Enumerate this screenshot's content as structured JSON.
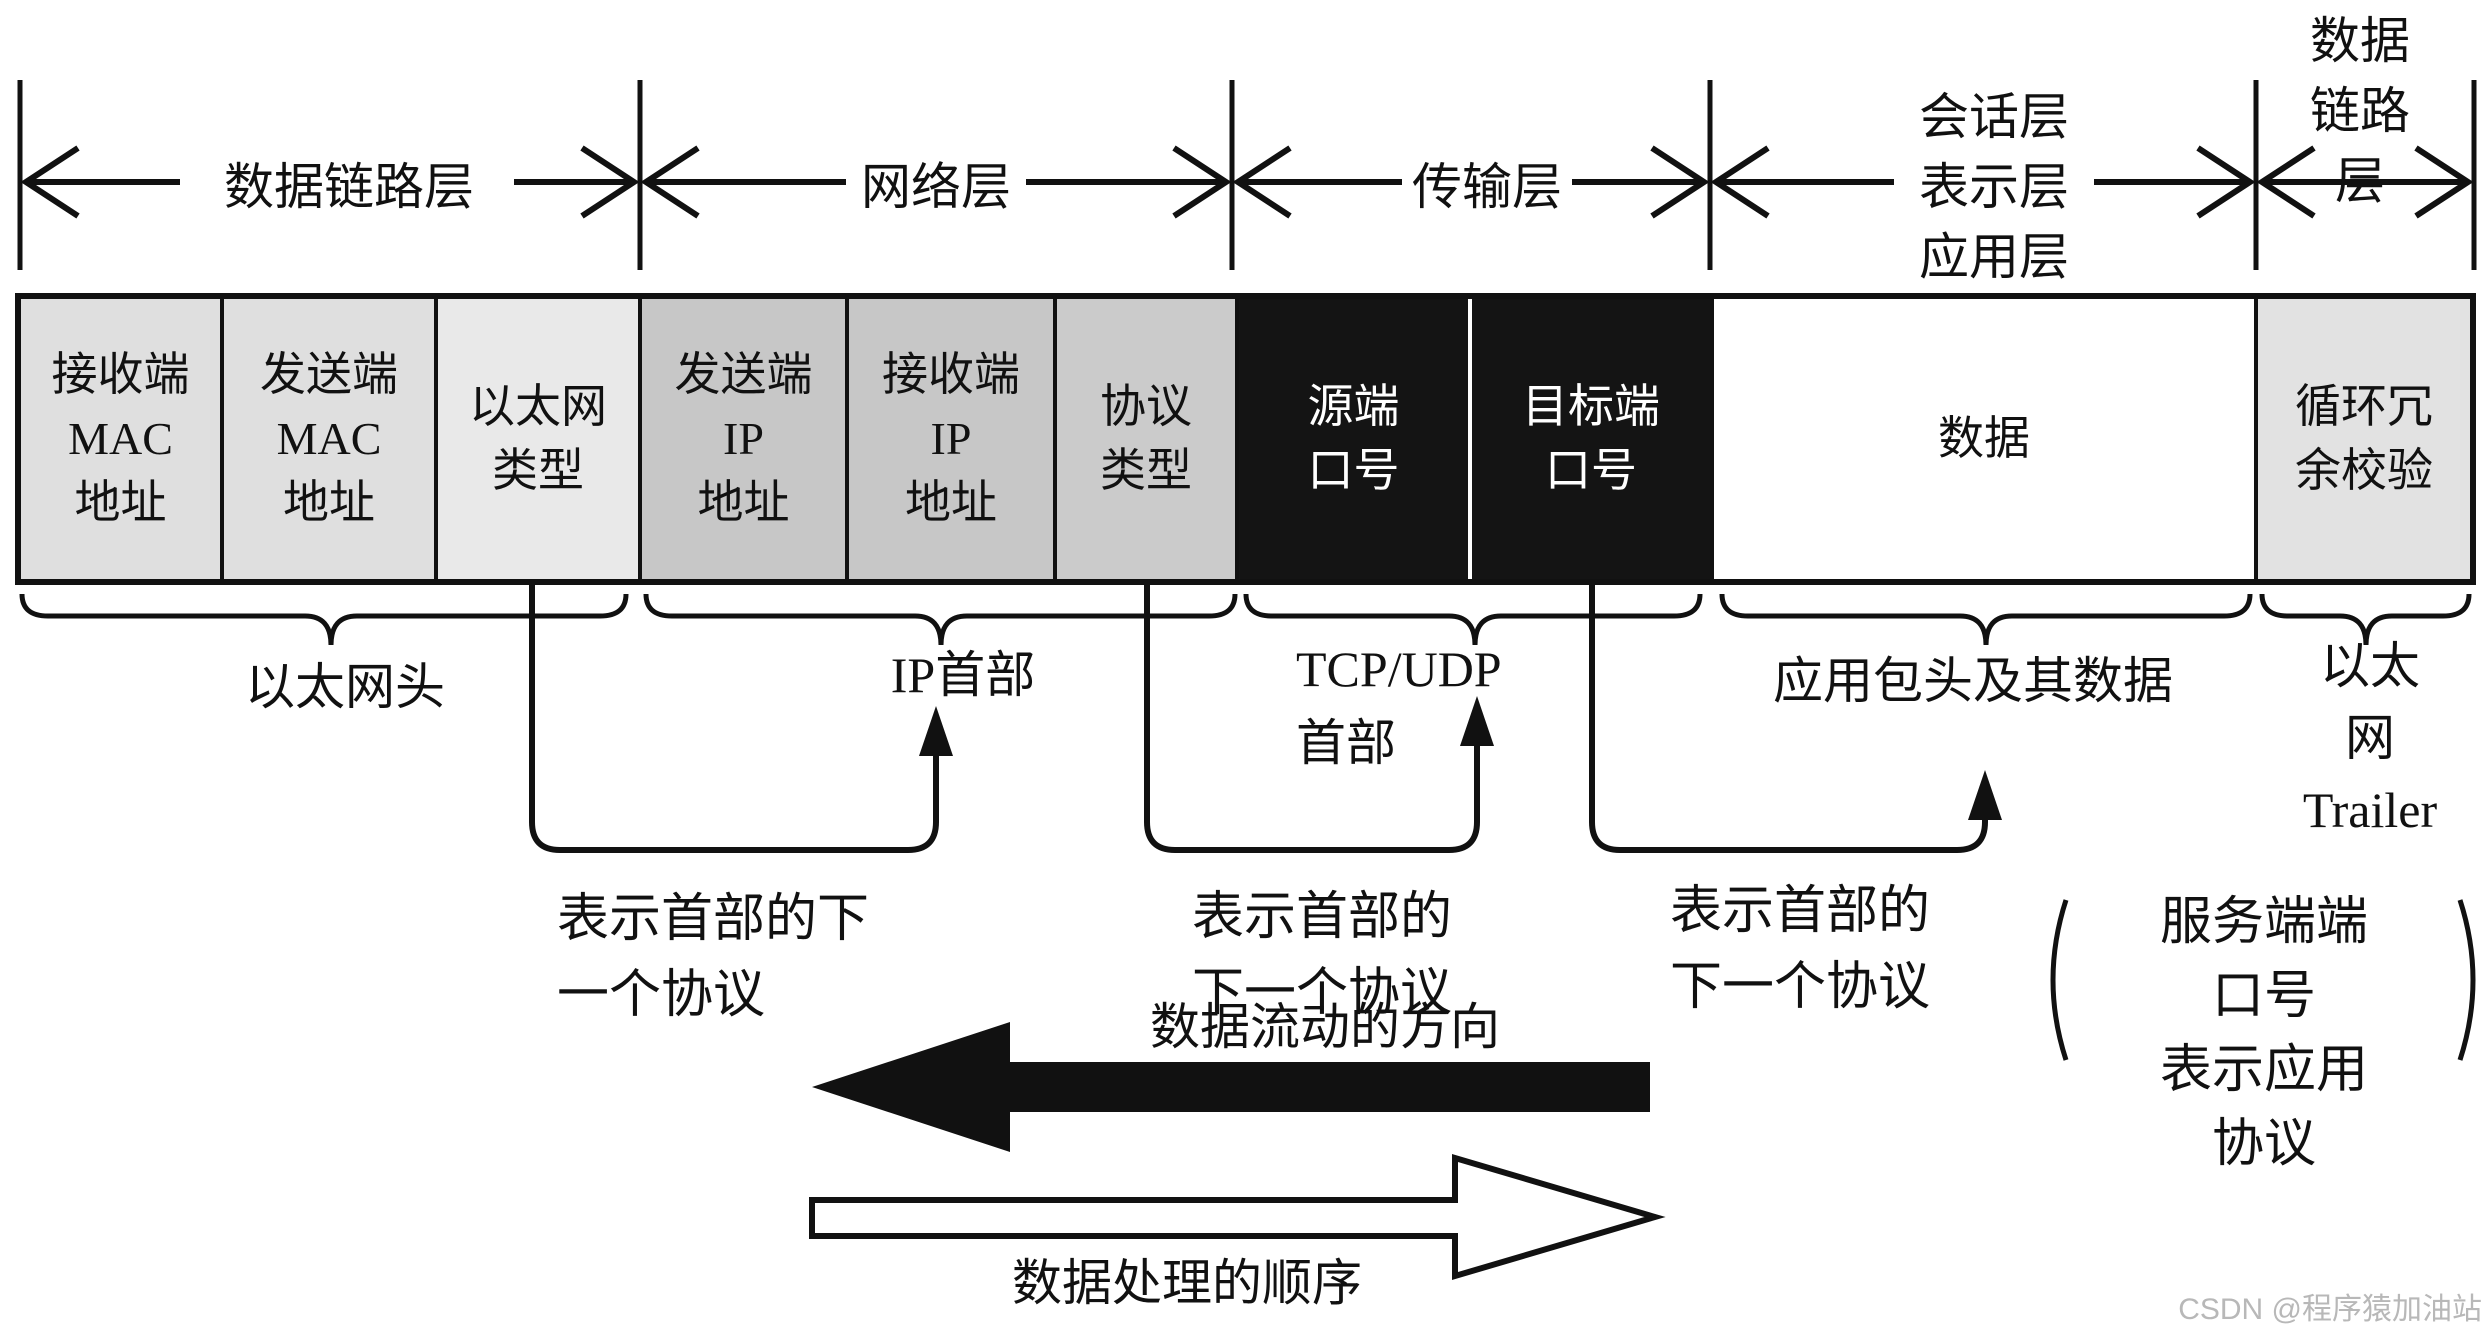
{
  "osi": {
    "datalink_left": "数据链路层",
    "network": "网络层",
    "transport": "传输层",
    "upper": [
      "会话层",
      "表示层",
      "应用层"
    ],
    "datalink_right": [
      "数据",
      "链路层"
    ]
  },
  "packet": {
    "cells": [
      {
        "label": "接收端\nMAC\n地址",
        "bg": "#dfdfdf",
        "fg": "#111111"
      },
      {
        "label": "发送端\nMAC\n地址",
        "bg": "#dfdfdf",
        "fg": "#111111"
      },
      {
        "label": "以太网\n类型",
        "bg": "#e9e9e9",
        "fg": "#111111"
      },
      {
        "label": "发送端\nIP\n地址",
        "bg": "#c7c7c7",
        "fg": "#111111"
      },
      {
        "label": "接收端\nIP\n地址",
        "bg": "#c7c7c7",
        "fg": "#111111"
      },
      {
        "label": "协议\n类型",
        "bg": "#cbcbcb",
        "fg": "#111111"
      },
      {
        "label": "源端\n口号",
        "bg": "#141414",
        "fg": "#ffffff"
      },
      {
        "label": "目标端\n口号",
        "bg": "#141414",
        "fg": "#ffffff"
      },
      {
        "label": "数据",
        "bg": "#ffffff",
        "fg": "#111111"
      },
      {
        "label": "循环冗\n余校验",
        "bg": "#e2e2e2",
        "fg": "#111111"
      }
    ]
  },
  "braces": {
    "ethernet_header": "以太网头",
    "ip_header": "IP首部",
    "tcp_udp_header": "TCP/UDP\n首部",
    "app_header_data": "应用包头及其数据",
    "ethernet_trailer": "以太网\nTrailer"
  },
  "annotations": {
    "next_protocol_1": "表示首部的下\n一个协议",
    "next_protocol_2": "表示首部的\n下一个协议",
    "next_protocol_3": "表示首部的\n下一个协议",
    "side_note": "服务端端口号\n表示应用协议"
  },
  "flow": {
    "data_flow_label": "数据流动的方向",
    "process_order_label": "数据处理的顺序"
  },
  "watermark": "CSDN @程序猿加油站",
  "colors": {
    "line": "#111111",
    "cell_light": "#dfdfdf",
    "cell_lighter": "#e9e9e9",
    "cell_mid": "#c7c7c7",
    "cell_dark": "#141414",
    "watermark": "#b8b8b8"
  }
}
